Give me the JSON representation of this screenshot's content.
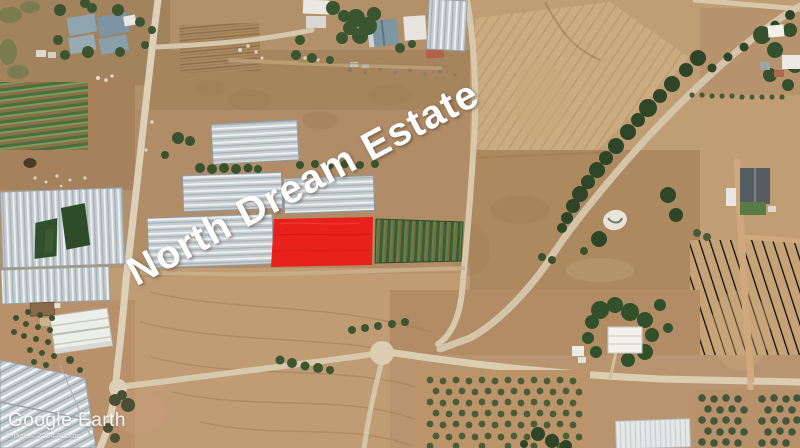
{
  "map": {
    "overlay_label": "North Dream Estate",
    "watermark": "Google Earth",
    "attribution": "Image © 2024 Airbus",
    "colors": {
      "highlight_plot": "#e8211c",
      "overlay_text": "#ffffff",
      "soil": "#b2906a",
      "road": "#d8c9ac",
      "greenhouse": "#c6ced2",
      "vegetation": "#3a5630"
    },
    "features": {
      "highlighted_plot": "red-highlighted-land-plot",
      "greenhouse_rows": "greenhouse-rows",
      "crop_field": "green-crop-rows",
      "tree_road": "tree-lined-road",
      "orchard": "orchard-grid",
      "warehouse": "farm-warehouse"
    }
  }
}
